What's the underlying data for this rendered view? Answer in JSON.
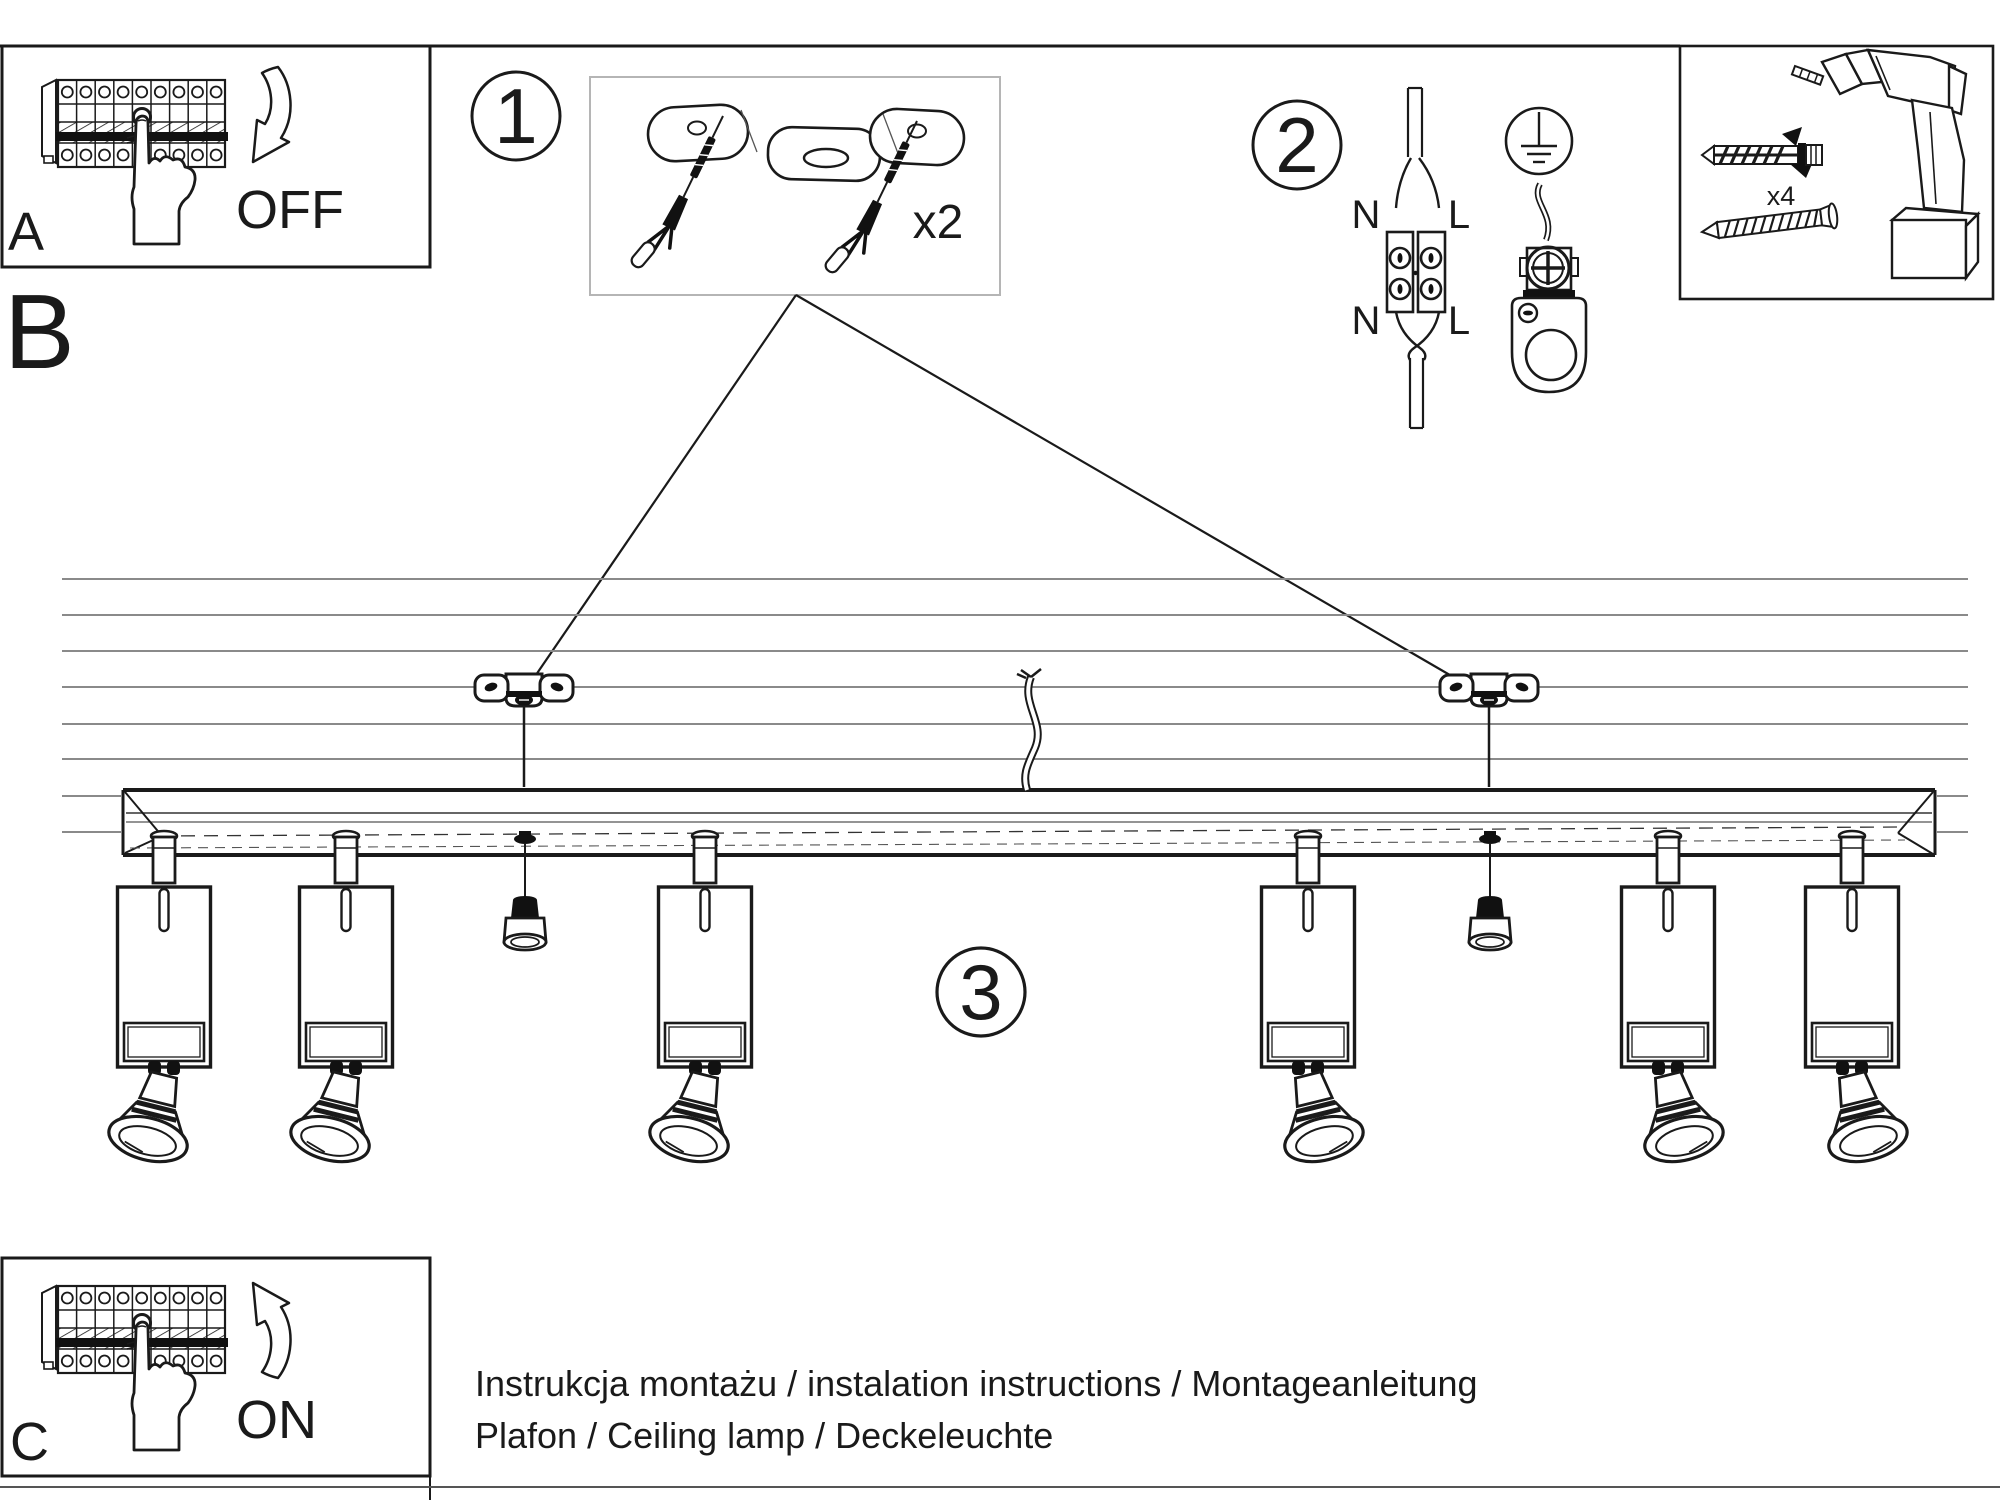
{
  "steps": {
    "a": {
      "label": "A",
      "action": "OFF"
    },
    "b": {
      "label": "B"
    },
    "c": {
      "label": "C",
      "action": "ON"
    },
    "one": {
      "number": "1",
      "quantity": "x2"
    },
    "two": {
      "number": "2",
      "n": "N",
      "l": "L"
    },
    "three": {
      "number": "3"
    }
  },
  "tools": {
    "quantity": "x4"
  },
  "footer": {
    "line1": "Instrukcja montażu / instalation instructions / Montageanleitung",
    "line2": "Plafon / Ceiling lamp / Deckeleuchte"
  },
  "colors": {
    "ink": "#1a1a1a",
    "ceiling_line": "#8a8a8a",
    "light_box_border": "#b5b5b5"
  }
}
